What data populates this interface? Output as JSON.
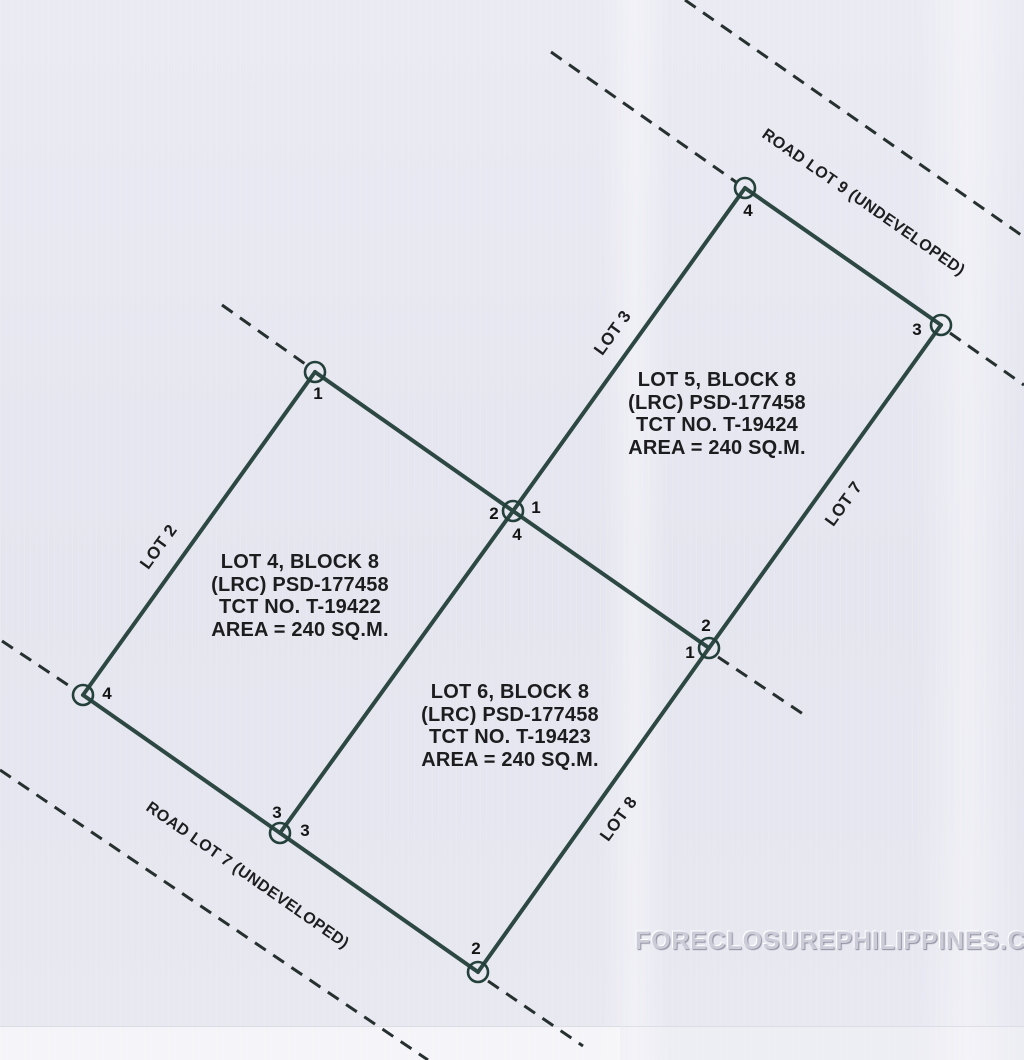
{
  "page": {
    "background": "#e7e7f0"
  },
  "watermark": {
    "text": "FORECLOSUREPHILIPPINES.COM"
  },
  "plan": {
    "colors": {
      "boundary": "#2d4842",
      "dashed": "#26302e",
      "marker": "#24403a",
      "label": "#141414"
    },
    "boundary_lines": [
      {
        "x1": 315,
        "y1": 372,
        "x2": 513,
        "y2": 511
      },
      {
        "x1": 513,
        "y1": 511,
        "x2": 709,
        "y2": 648
      },
      {
        "x1": 83,
        "y1": 695,
        "x2": 280,
        "y2": 833
      },
      {
        "x1": 280,
        "y1": 833,
        "x2": 478,
        "y2": 972
      },
      {
        "x1": 315,
        "y1": 372,
        "x2": 83,
        "y2": 695
      },
      {
        "x1": 513,
        "y1": 511,
        "x2": 280,
        "y2": 833
      },
      {
        "x1": 513,
        "y1": 511,
        "x2": 745,
        "y2": 188
      },
      {
        "x1": 745,
        "y1": 188,
        "x2": 941,
        "y2": 325
      },
      {
        "x1": 941,
        "y1": 325,
        "x2": 709,
        "y2": 648
      },
      {
        "x1": 709,
        "y1": 648,
        "x2": 478,
        "y2": 972
      }
    ],
    "dashed_lines": [
      {
        "x1": 222,
        "y1": 305,
        "x2": 308,
        "y2": 366
      },
      {
        "x1": 2,
        "y1": 641,
        "x2": 74,
        "y2": 689
      },
      {
        "x1": 551,
        "y1": 52,
        "x2": 736,
        "y2": 182
      },
      {
        "x1": 685,
        "y1": 0,
        "x2": 1024,
        "y2": 237
      },
      {
        "x1": 950,
        "y1": 333,
        "x2": 1024,
        "y2": 385
      },
      {
        "x1": 718,
        "y1": 657,
        "x2": 806,
        "y2": 716
      },
      {
        "x1": 488,
        "y1": 981,
        "x2": 583,
        "y2": 1046
      },
      {
        "x1": 0,
        "y1": 770,
        "x2": 428,
        "y2": 1060
      }
    ],
    "corner_markers": [
      {
        "x": 315,
        "y": 372
      },
      {
        "x": 513,
        "y": 511
      },
      {
        "x": 83,
        "y": 695
      },
      {
        "x": 280,
        "y": 833
      },
      {
        "x": 745,
        "y": 188
      },
      {
        "x": 941,
        "y": 325
      },
      {
        "x": 709,
        "y": 648
      },
      {
        "x": 478,
        "y": 972
      }
    ],
    "corner_labels": [
      {
        "text": "1",
        "x": 318,
        "y": 394
      },
      {
        "text": "2",
        "x": 494,
        "y": 514
      },
      {
        "text": "1",
        "x": 536,
        "y": 508
      },
      {
        "text": "4",
        "x": 517,
        "y": 535
      },
      {
        "text": "4",
        "x": 107,
        "y": 694
      },
      {
        "text": "3",
        "x": 277,
        "y": 813
      },
      {
        "text": "3",
        "x": 305,
        "y": 831
      },
      {
        "text": "4",
        "x": 748,
        "y": 211
      },
      {
        "text": "3",
        "x": 917,
        "y": 330
      },
      {
        "text": "2",
        "x": 706,
        "y": 626
      },
      {
        "text": "1",
        "x": 690,
        "y": 653
      },
      {
        "text": "2",
        "x": 476,
        "y": 949
      }
    ],
    "lot_blocks": [
      {
        "x": 300,
        "y": 551,
        "lines": [
          "LOT 4, BLOCK 8",
          "(LRC) PSD-177458",
          "TCT NO. T-19422",
          "AREA = 240 SQ.M."
        ]
      },
      {
        "x": 717,
        "y": 369,
        "lines": [
          "LOT 5, BLOCK 8",
          "(LRC) PSD-177458",
          "TCT NO. T-19424",
          "AREA = 240 SQ.M."
        ]
      },
      {
        "x": 510,
        "y": 681,
        "lines": [
          "LOT 6, BLOCK 8",
          "(LRC) PSD-177458",
          "TCT NO. T-19423",
          "AREA = 240 SQ.M."
        ]
      }
    ],
    "adjacent_labels": [
      {
        "text": "LOT 2",
        "x": 159,
        "y": 547,
        "angle": -54,
        "size": 17
      },
      {
        "text": "LOT 3",
        "x": 613,
        "y": 333,
        "angle": -54,
        "size": 17
      },
      {
        "text": "LOT 7",
        "x": 844,
        "y": 504,
        "angle": -54,
        "size": 17
      },
      {
        "text": "LOT 8",
        "x": 619,
        "y": 819,
        "angle": -54,
        "size": 17
      },
      {
        "text": "ROAD LOT 9 (UNDEVELOPED)",
        "x": 863,
        "y": 203,
        "angle": 35,
        "size": 16
      },
      {
        "text": "ROAD LOT 7 (UNDEVELOPED)",
        "x": 247,
        "y": 876,
        "angle": 35,
        "size": 16
      }
    ]
  }
}
